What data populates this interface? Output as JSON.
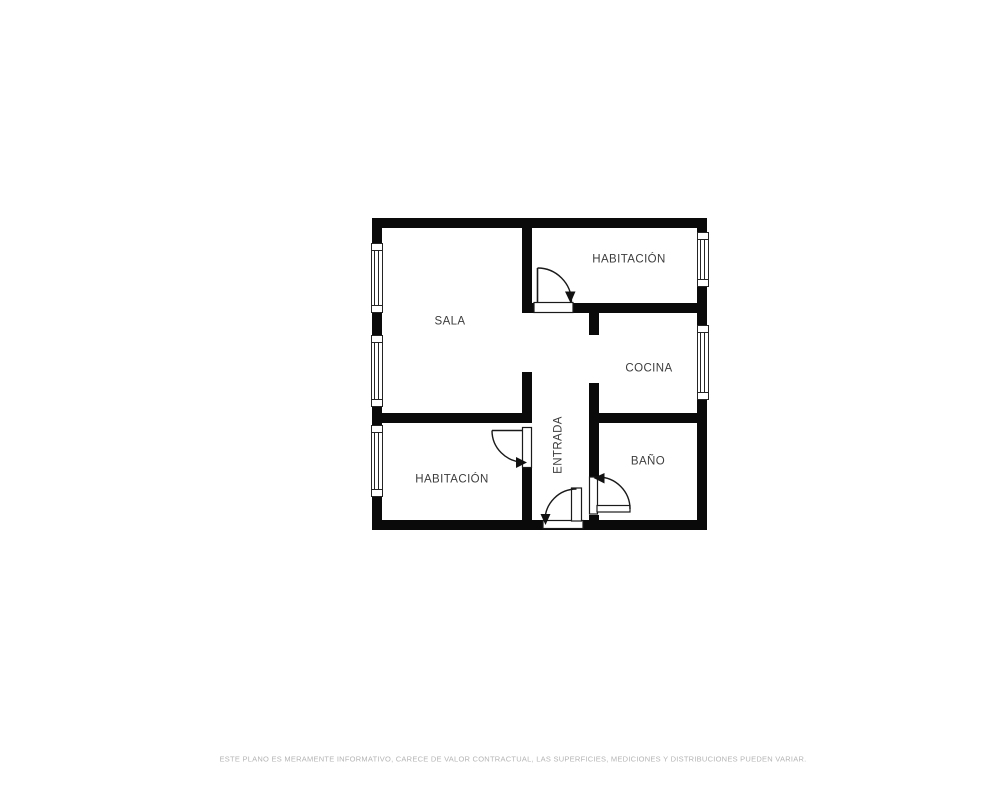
{
  "colors": {
    "background": "#ffffff",
    "wall": "#0a0a0a",
    "window_line": "#242424",
    "door_line": "#1a1a1a",
    "room_label": "#3d3d3d",
    "disclaimer_text": "#b4b4b4"
  },
  "rooms": {
    "sala": {
      "label": "SALA"
    },
    "habitacion_top": {
      "label": "HABITACIÓN"
    },
    "cocina": {
      "label": "COCINA"
    },
    "entrada": {
      "label": "ENTRADA"
    },
    "bano": {
      "label": "BAÑO"
    },
    "habitacion_bottom": {
      "label": "HABITACIÓN"
    }
  },
  "footer": {
    "disclaimer": "ESTE PLANO ES MERAMENTE INFORMATIVO, CARECE DE VALOR CONTRACTUAL, LAS SUPERFICIES, MEDICIONES Y DISTRIBUCIONES PUEDEN VARIAR."
  }
}
